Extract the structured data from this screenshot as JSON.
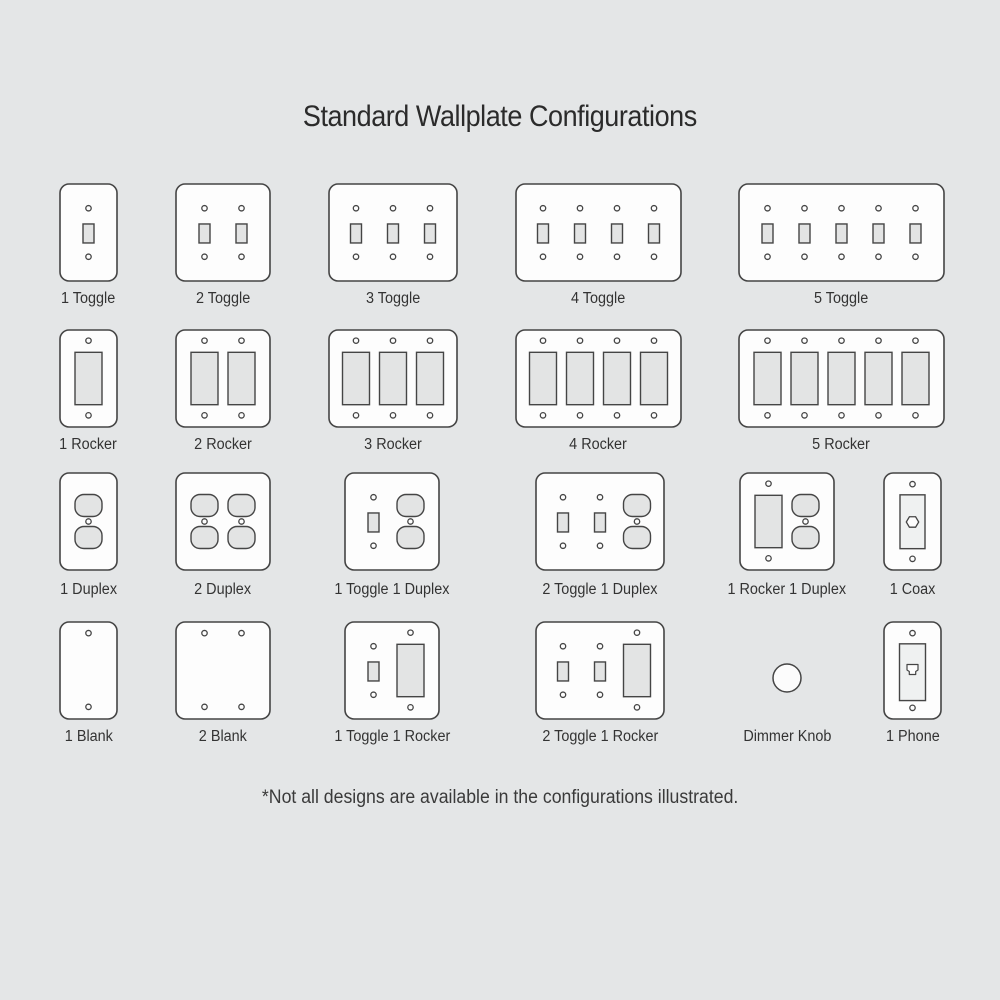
{
  "title": "Standard Wallplate Configurations",
  "footnote": "*Not all designs are available in the configurations illustrated.",
  "colors": {
    "background": "#e4e6e7",
    "plate_fill": "#fdfdfd",
    "outline": "#454545",
    "device_fill": "#e3e4e4",
    "insert_fill": "#eff1f1",
    "knob_fill": "#fcfcfc",
    "label_text": "#333333",
    "title_text": "#2b2b2b",
    "footnote_text": "#3a3a3a"
  },
  "layout": {
    "plate_height": 97,
    "gang_pitch": 37,
    "plate_corner_radius": 9
  },
  "rows": [
    {
      "plate_top": 184,
      "label_top": 290,
      "plates": [
        {
          "label": "1 Toggle",
          "x": 60,
          "width": 57,
          "gangs": [
            "toggle"
          ]
        },
        {
          "label": "2 Toggle",
          "x": 176,
          "width": 94,
          "gangs": [
            "toggle",
            "toggle"
          ]
        },
        {
          "label": "3 Toggle",
          "x": 329,
          "width": 128,
          "gangs": [
            "toggle",
            "toggle",
            "toggle"
          ]
        },
        {
          "label": "4 Toggle",
          "x": 516,
          "width": 165,
          "gangs": [
            "toggle",
            "toggle",
            "toggle",
            "toggle"
          ]
        },
        {
          "label": "5 Toggle",
          "x": 739,
          "width": 205,
          "gangs": [
            "toggle",
            "toggle",
            "toggle",
            "toggle",
            "toggle"
          ]
        }
      ]
    },
    {
      "plate_top": 330,
      "label_top": 436,
      "plates": [
        {
          "label": "1 Rocker",
          "x": 60,
          "width": 57,
          "gangs": [
            "rocker"
          ]
        },
        {
          "label": "2 Rocker",
          "x": 176,
          "width": 94,
          "gangs": [
            "rocker",
            "rocker"
          ]
        },
        {
          "label": "3 Rocker",
          "x": 329,
          "width": 128,
          "gangs": [
            "rocker",
            "rocker",
            "rocker"
          ]
        },
        {
          "label": "4 Rocker",
          "x": 516,
          "width": 165,
          "gangs": [
            "rocker",
            "rocker",
            "rocker",
            "rocker"
          ]
        },
        {
          "label": "5 Rocker",
          "x": 739,
          "width": 205,
          "gangs": [
            "rocker",
            "rocker",
            "rocker",
            "rocker",
            "rocker"
          ]
        }
      ]
    },
    {
      "plate_top": 473,
      "label_top": 581,
      "plates": [
        {
          "label": "1 Duplex",
          "x": 60,
          "width": 57,
          "gangs": [
            "duplex"
          ]
        },
        {
          "label": "2 Duplex",
          "x": 176,
          "width": 94,
          "gangs": [
            "duplex",
            "duplex"
          ]
        },
        {
          "label": "1 Toggle 1 Duplex",
          "x": 345,
          "width": 94,
          "gangs": [
            "toggle",
            "duplex"
          ]
        },
        {
          "label": "2 Toggle 1 Duplex",
          "x": 536,
          "width": 128,
          "gangs": [
            "toggle",
            "toggle",
            "duplex"
          ]
        },
        {
          "label": "1 Rocker 1 Duplex",
          "x": 740,
          "width": 94,
          "gangs": [
            "rocker",
            "duplex"
          ]
        },
        {
          "label": "1 Coax",
          "x": 884,
          "width": 57,
          "gangs": [
            "coax"
          ]
        }
      ]
    },
    {
      "plate_top": 622,
      "label_top": 728,
      "plates": [
        {
          "label": "1 Blank",
          "x": 60,
          "width": 57,
          "gangs": [
            "blank"
          ]
        },
        {
          "label": "2 Blank",
          "x": 176,
          "width": 94,
          "gangs": [
            "blank",
            "blank"
          ]
        },
        {
          "label": "1 Toggle 1 Rocker",
          "x": 345,
          "width": 94,
          "gangs": [
            "toggle",
            "rocker"
          ]
        },
        {
          "label": "2 Toggle 1 Rocker",
          "x": 536,
          "width": 128,
          "gangs": [
            "toggle",
            "toggle",
            "rocker"
          ]
        },
        {
          "label": "Dimmer Knob",
          "type": "dimmer",
          "cx": 787,
          "cy": 678,
          "radius": 14
        },
        {
          "label": "1 Phone",
          "x": 884,
          "width": 57,
          "gangs": [
            "phone"
          ]
        }
      ]
    }
  ]
}
